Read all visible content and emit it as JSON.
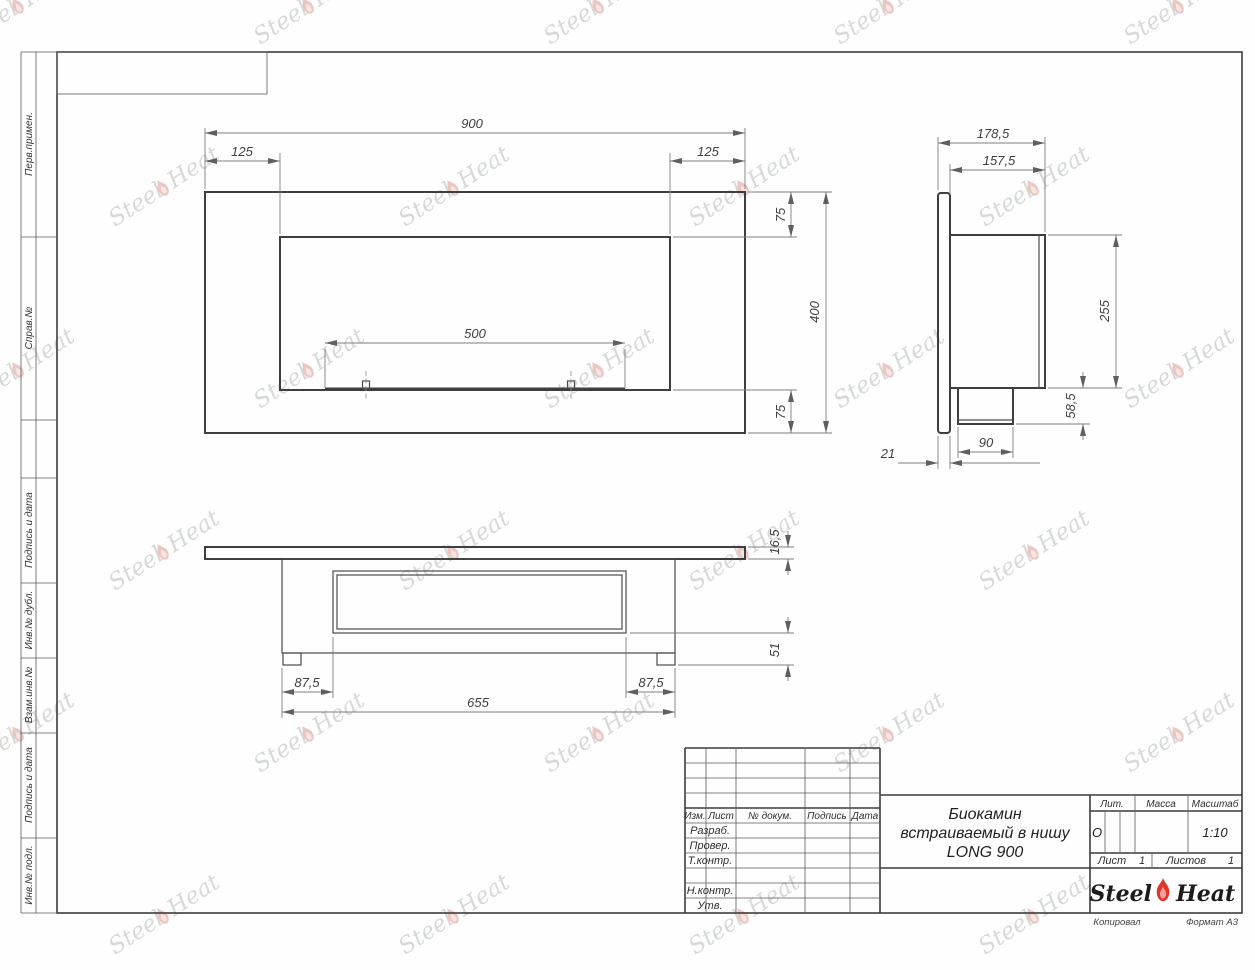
{
  "watermark": {
    "word1": "Steel",
    "word2": "Heat"
  },
  "margin": {
    "labels": [
      "Перв.примен.",
      "Справ.№",
      "Подпись и дата",
      "Инв.№ дубл.",
      "Взам.инв.№",
      "Подпись и дата",
      "Инв.№ подл."
    ]
  },
  "views": {
    "front": {
      "width": "900",
      "offset_left": "125",
      "offset_right": "125",
      "top_margin": "75",
      "height": "400",
      "bottom_margin": "75",
      "burner_span": "500"
    },
    "side": {
      "depth_total": "178,5",
      "depth_body": "157,5",
      "body_height": "255",
      "box_height": "58,5",
      "box_width": "90",
      "flange_thickness": "21"
    },
    "bottom": {
      "plate_thickness": "16,5",
      "inner_depth": "51",
      "margin_left": "87,5",
      "margin_right": "87,5",
      "body_width": "655"
    }
  },
  "title_block": {
    "title_line1": "Биокамин",
    "title_line2": "встраиваемый в нишу",
    "title_line3": "LONG 900",
    "col_izm": "Изм.",
    "col_list": "Лист",
    "col_doc": "№ докум.",
    "col_sign": "Подпись",
    "col_date": "Дата",
    "row_razrab": "Разраб.",
    "row_prover": "Провер.",
    "row_tkontr": "Т.контр.",
    "row_nkontr": "Н.контр.",
    "row_utv": "Утв.",
    "lit_header": "Лит.",
    "mass_header": "Масса",
    "scale_header": "Масштаб",
    "lit_value": "О",
    "scale_value": "1:10",
    "sheet_label": "Лист",
    "sheet_number": "1",
    "sheets_label": "Листов",
    "sheets_total": "1",
    "logo_word1": "Steel",
    "logo_word2": "Heat",
    "footer_copy": "Копировал",
    "footer_format": "Формат А3"
  },
  "colors": {
    "logo_flame": "#e3342b",
    "watermark_flame": "#eac7c3",
    "line": "#3c3c3c"
  }
}
